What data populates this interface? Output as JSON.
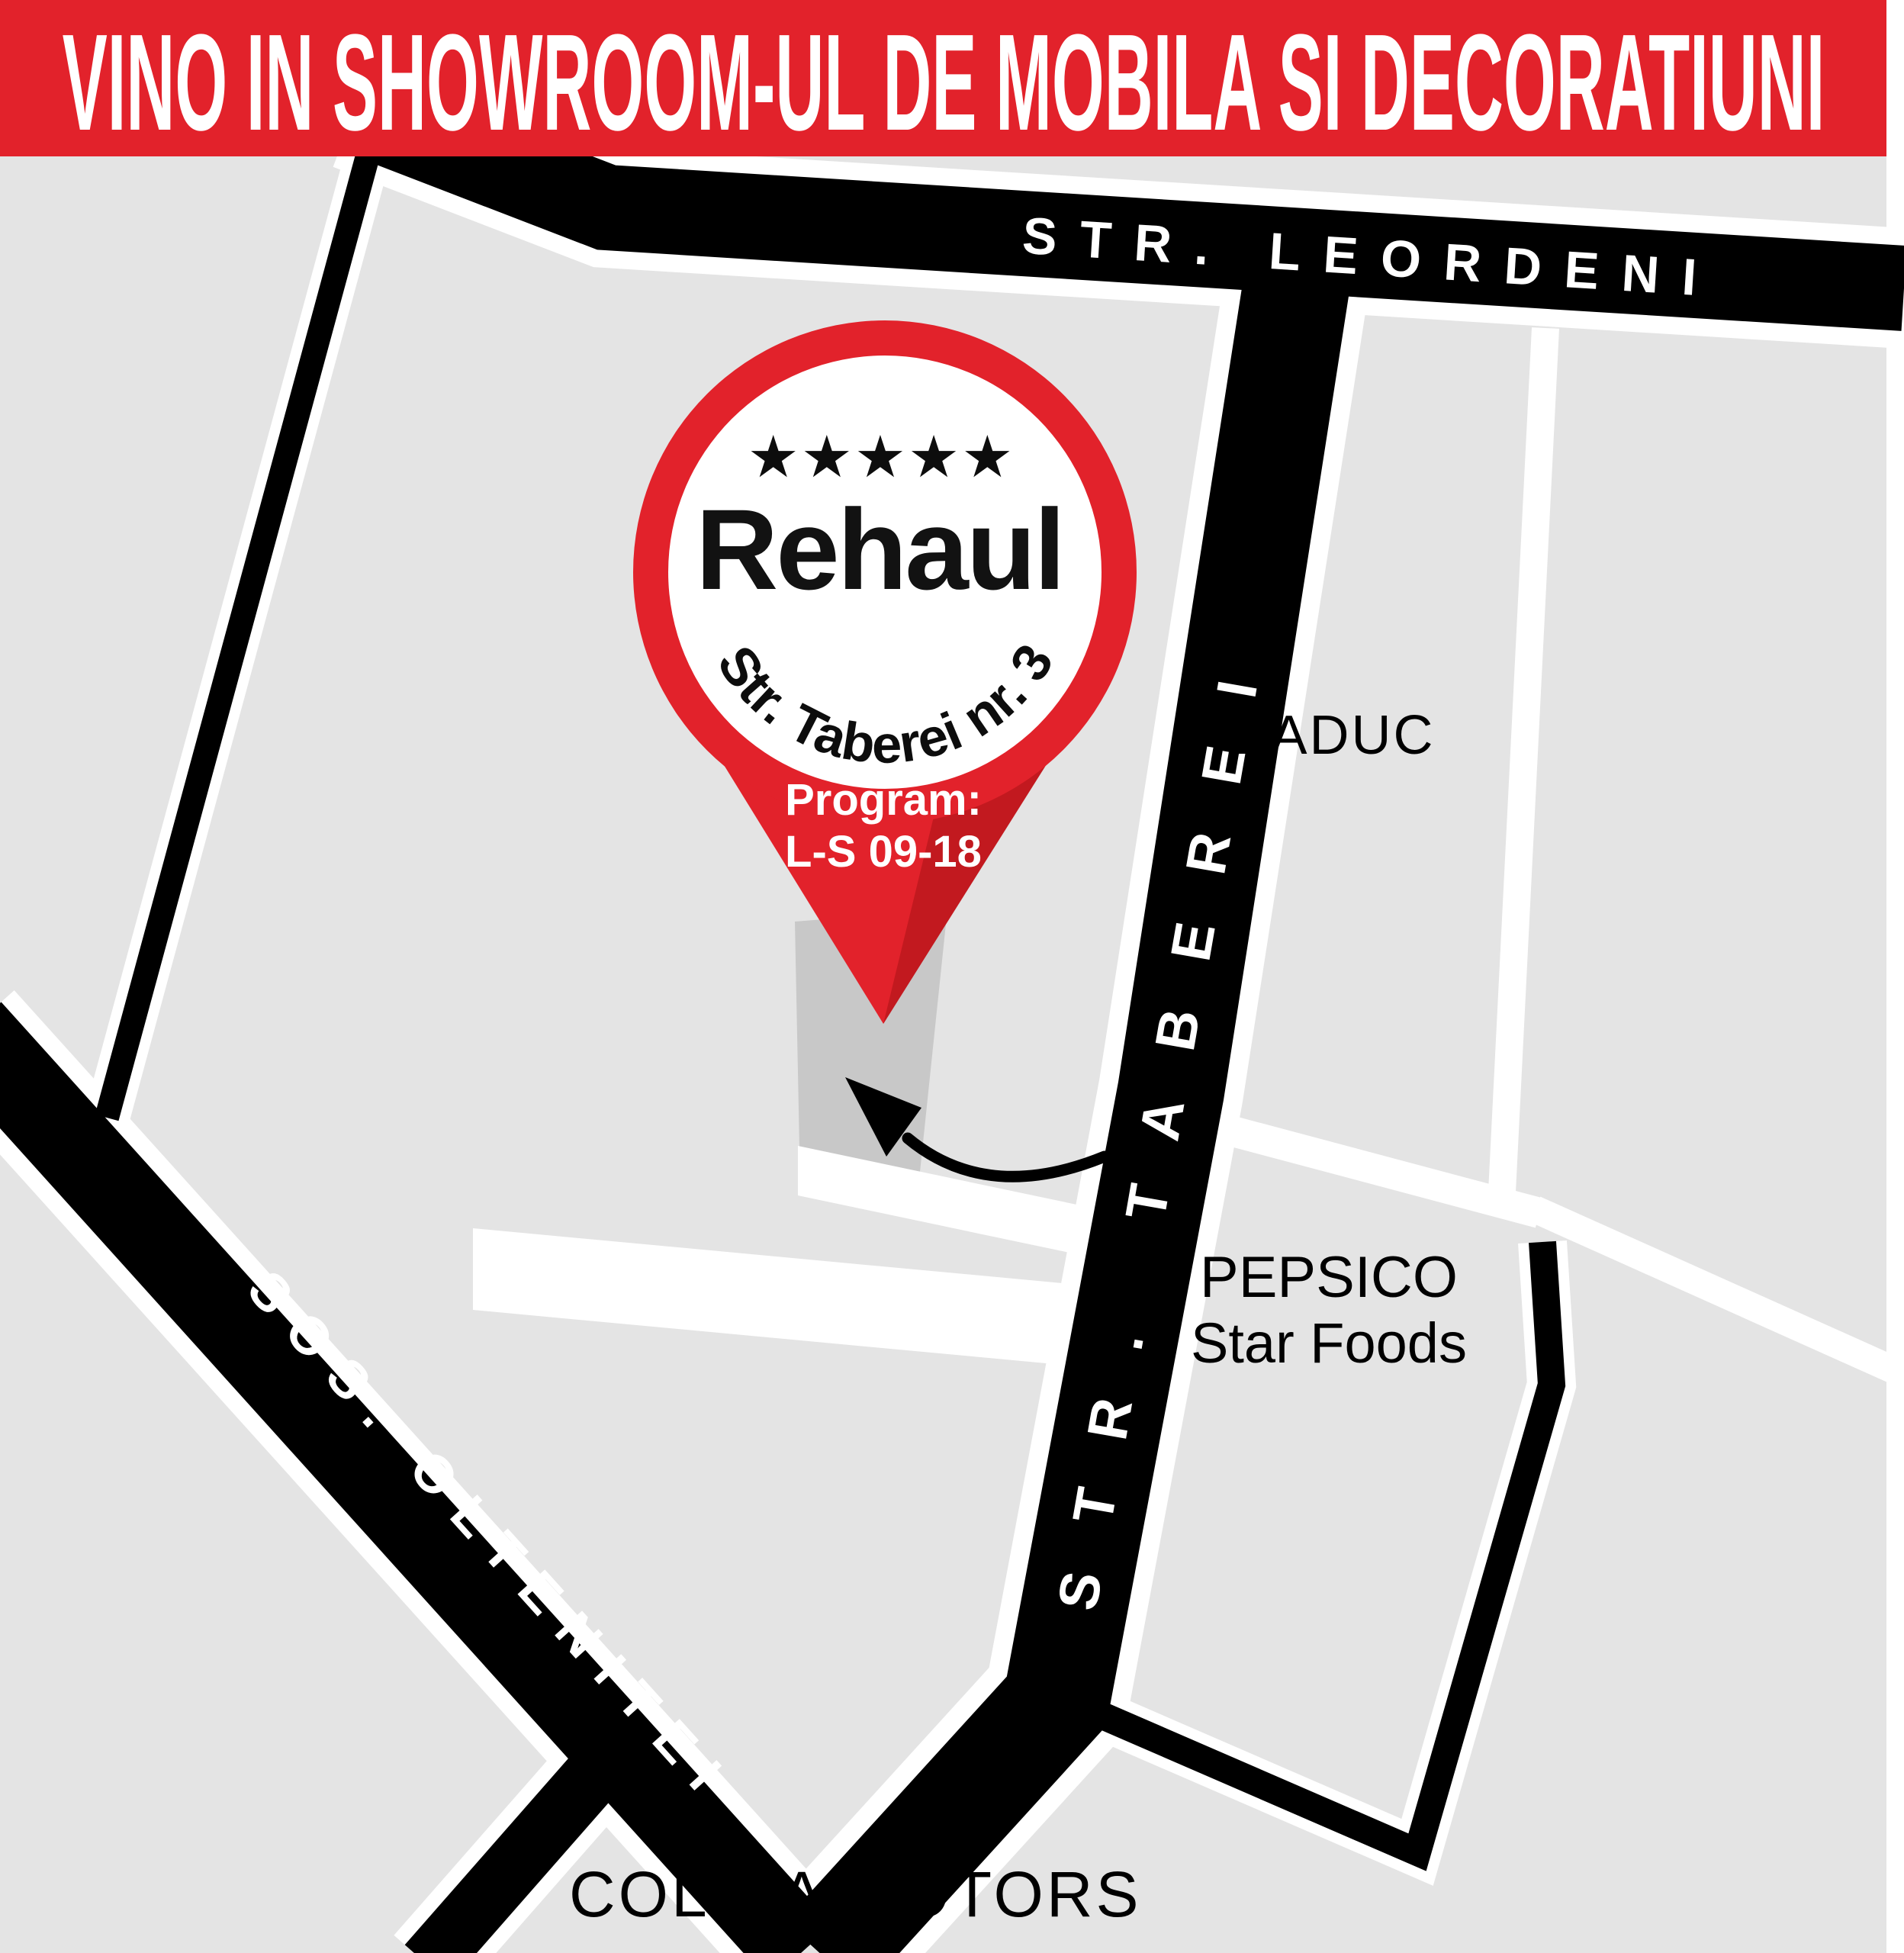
{
  "banner": {
    "text": "VINO IN SHOWROOM-UL DE MOBILA SI DECORATIUNI"
  },
  "roads": {
    "leordeni": "STR. LEORDENI",
    "taberei": "STR. TABEREI",
    "oltenitei": "SOS. OLTENITEI"
  },
  "places": {
    "baduc": "BADUC",
    "pepsico_line1": "PEPSICO",
    "pepsico_line2": "Star Foods",
    "colina_motors": "COLINA MOTORS"
  },
  "pin": {
    "stars": "★★★★★",
    "brand": "Rehaul",
    "address": "Str. Taberei nr. 3",
    "program_label": "Program:",
    "program_hours": "L-S 09-18"
  },
  "colors": {
    "banner_red": "#e2222b",
    "pin_red": "#e2222b",
    "pin_red_dark": "#c2191f",
    "map_gray": "#e4e4e4",
    "building_gray": "#c8c8c8",
    "road_black": "#000000",
    "casing_white": "#ffffff"
  }
}
